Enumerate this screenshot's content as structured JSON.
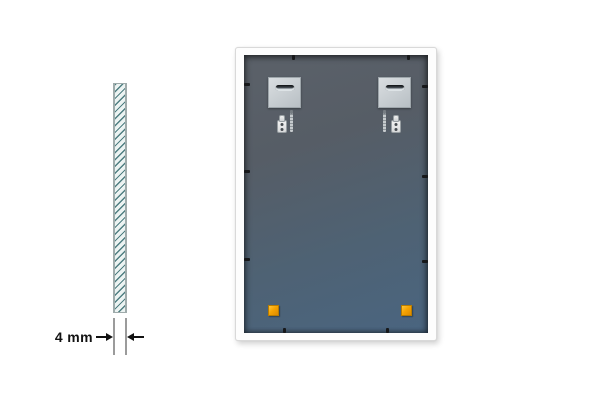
{
  "annotation": {
    "thickness_label": "4 mm"
  },
  "colors": {
    "background": "#ffffff",
    "frame": "#fdfdfd",
    "panel_top": "#5b6169",
    "panel_bottom": "#4a6580",
    "metal_plate": "#c8ced2",
    "corner_pad": "#f5a302",
    "glass_hatch": "#47797c",
    "glass_fill": "#ecf3f2",
    "annotation_text": "#121212",
    "clip": "#17181a"
  }
}
